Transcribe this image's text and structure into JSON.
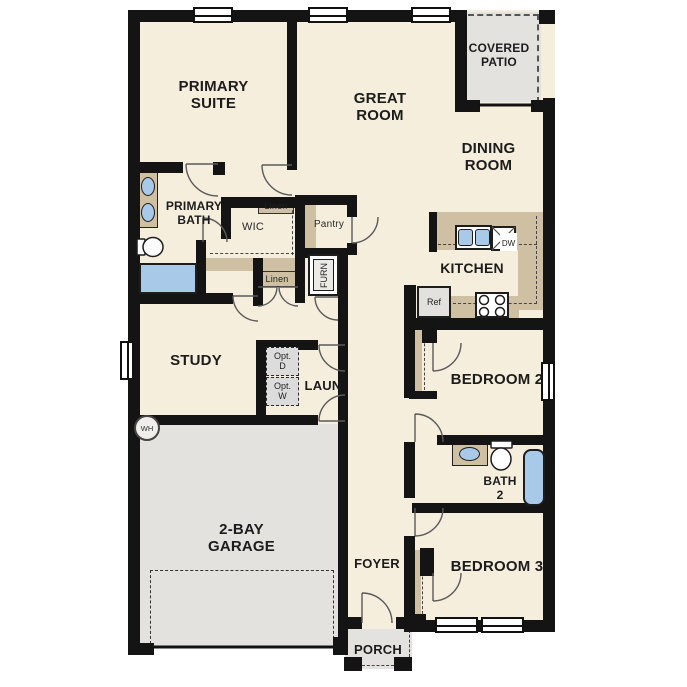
{
  "plan": {
    "title": "single-story floor plan",
    "rooms": {
      "primary_suite": "PRIMARY SUITE",
      "great_room": "GREAT ROOM",
      "covered_patio": "COVERED PATIO",
      "dining_room": "DINING ROOM",
      "kitchen": "KITCHEN",
      "primary_bath": "PRIMARY BATH",
      "wic": "WIC",
      "study": "STUDY",
      "laundry": "LAUN",
      "garage": "2-BAY GARAGE",
      "bedroom2": "BEDROOM 2",
      "bath2": "BATH 2",
      "bedroom3": "BEDROOM 3",
      "foyer": "FOYER",
      "porch": "PORCH"
    },
    "fixtures": {
      "linen1": "Linen",
      "linen2": "Linen",
      "pantry": "Pantry",
      "furnace": "FURN",
      "refrigerator": "Ref",
      "dishwasher": "DW",
      "water_heater": "WH",
      "opt_dryer": "Opt. D",
      "opt_washer": "Opt. W"
    },
    "colors": {
      "floor": "#f6eedd",
      "wall": "#141414",
      "casework": "#cfc0a4",
      "concrete": "#e3e2df",
      "fixture_blue": "#a9c9e9"
    }
  }
}
